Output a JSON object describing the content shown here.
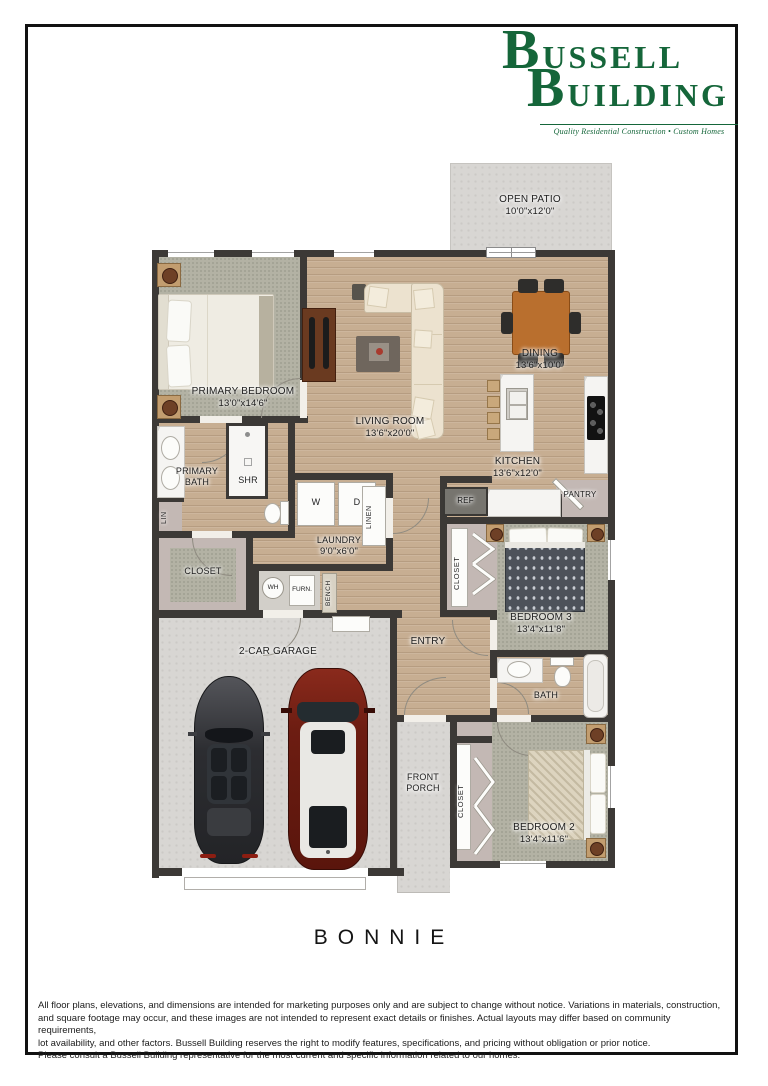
{
  "logo": {
    "line1": "BUSSELL",
    "line2": "BUILDING",
    "tagline": "Quality Residential Construction • Custom Homes",
    "brand_color": "#15663a"
  },
  "title": "BONNIE",
  "rooms": {
    "open_patio": {
      "label": "OPEN PATIO",
      "dims": "10'0\"x12'0\""
    },
    "primary_bedroom": {
      "label": "PRIMARY BEDROOM",
      "dims": "13'0\"x14'6\""
    },
    "living_room": {
      "label": "LIVING ROOM",
      "dims": "13'6\"x20'0\""
    },
    "dining": {
      "label": "DINING",
      "dims": "13'6\"x10'0\""
    },
    "kitchen": {
      "label": "KITCHEN",
      "dims": "13'6\"x12'0\""
    },
    "pantry": {
      "label": "PANTRY"
    },
    "primary_bath": {
      "label": "PRIMARY BATH"
    },
    "shower": {
      "label": "SHR"
    },
    "linen_small": {
      "label": "LIN"
    },
    "laundry": {
      "label": "LAUNDRY",
      "dims": "9'0\"x6'0\""
    },
    "washer": {
      "label": "W"
    },
    "dryer": {
      "label": "D"
    },
    "linen": {
      "label": "LINEN"
    },
    "closet_primary": {
      "label": "CLOSET"
    },
    "water_heater": {
      "label": "WH"
    },
    "furnace": {
      "label": "FURN."
    },
    "bench": {
      "label": "BENCH"
    },
    "garage": {
      "label": "2-CAR GARAGE"
    },
    "entry": {
      "label": "ENTRY"
    },
    "refrigerator": {
      "label": "REF"
    },
    "closet_bed3": {
      "label": "CLOSET"
    },
    "bedroom3": {
      "label": "BEDROOM 3",
      "dims": "13'4\"x11'8\""
    },
    "bath": {
      "label": "BATH"
    },
    "front_porch": {
      "label": "FRONT PORCH"
    },
    "closet_bed2": {
      "label": "CLOSET"
    },
    "bedroom2": {
      "label": "BEDROOM 2",
      "dims": "13'4\"x11'6\""
    }
  },
  "disclaimer": {
    "lines": [
      "All floor plans, elevations, and dimensions are intended for marketing purposes only and are subject to change without notice. Variations in materials, construction,",
      "and square footage may occur, and these images are not intended to represent exact details or finishes. Actual layouts may differ based on community requirements,",
      "lot availability, and other factors. Bussell Building reserves the right to modify features, specifications, and pricing without obligation or prior notice.",
      "Please consult a Bussell Building representative for the most current and specific information related to our homes."
    ]
  }
}
